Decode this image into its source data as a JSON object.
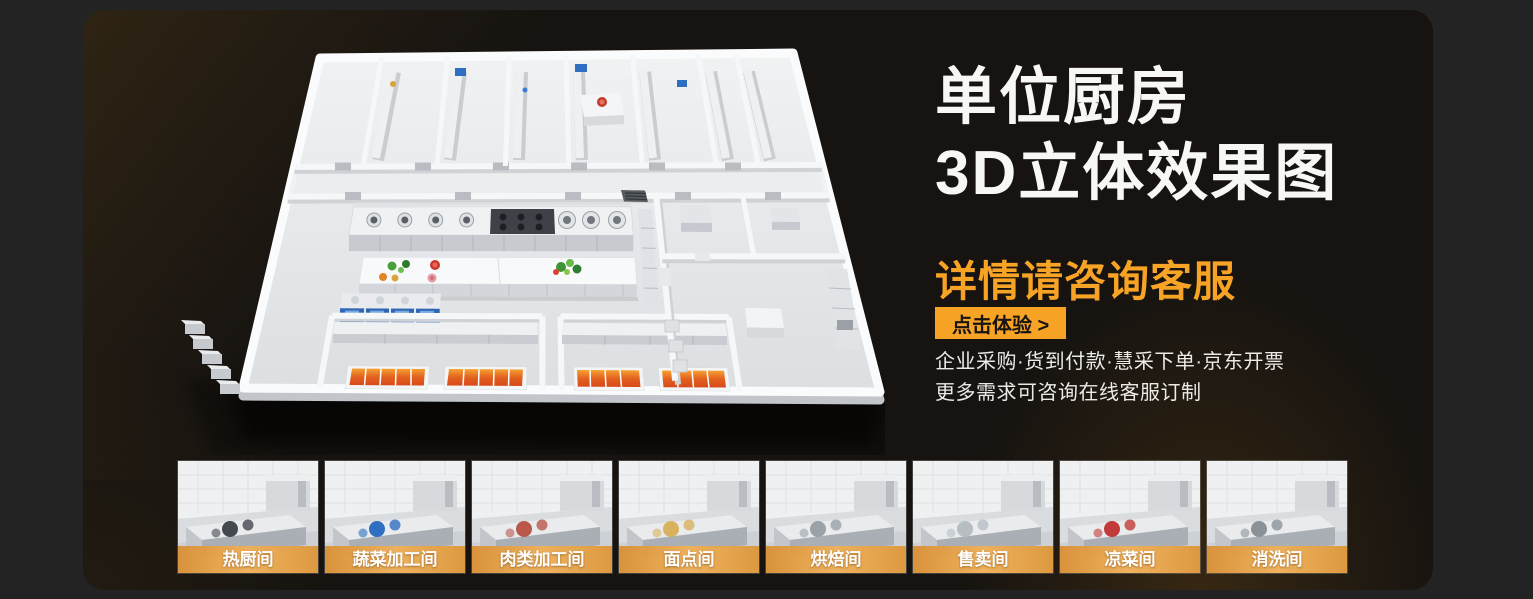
{
  "banner": {
    "title_line1": "单位厨房",
    "title_line2": "3D立体效果图",
    "subtitle": "详情请咨询客服",
    "cta_label": "点击体验 >",
    "desc_line1": "企业采购·货到付款·慧采下单·京东开票",
    "desc_line2": "更多需求可咨询在线客服订制",
    "colors": {
      "page_background": "#232323",
      "banner_background": "#161310",
      "accent_orange": "#f7a325",
      "title_white": "#f7f7f5"
    }
  },
  "gallery": {
    "items": [
      {
        "label": "热厨间"
      },
      {
        "label": "蔬菜加工间"
      },
      {
        "label": "肉类加工间"
      },
      {
        "label": "面点间"
      },
      {
        "label": "烘焙间"
      },
      {
        "label": "售卖间"
      },
      {
        "label": "凉菜间"
      },
      {
        "label": "消洗间"
      }
    ]
  }
}
